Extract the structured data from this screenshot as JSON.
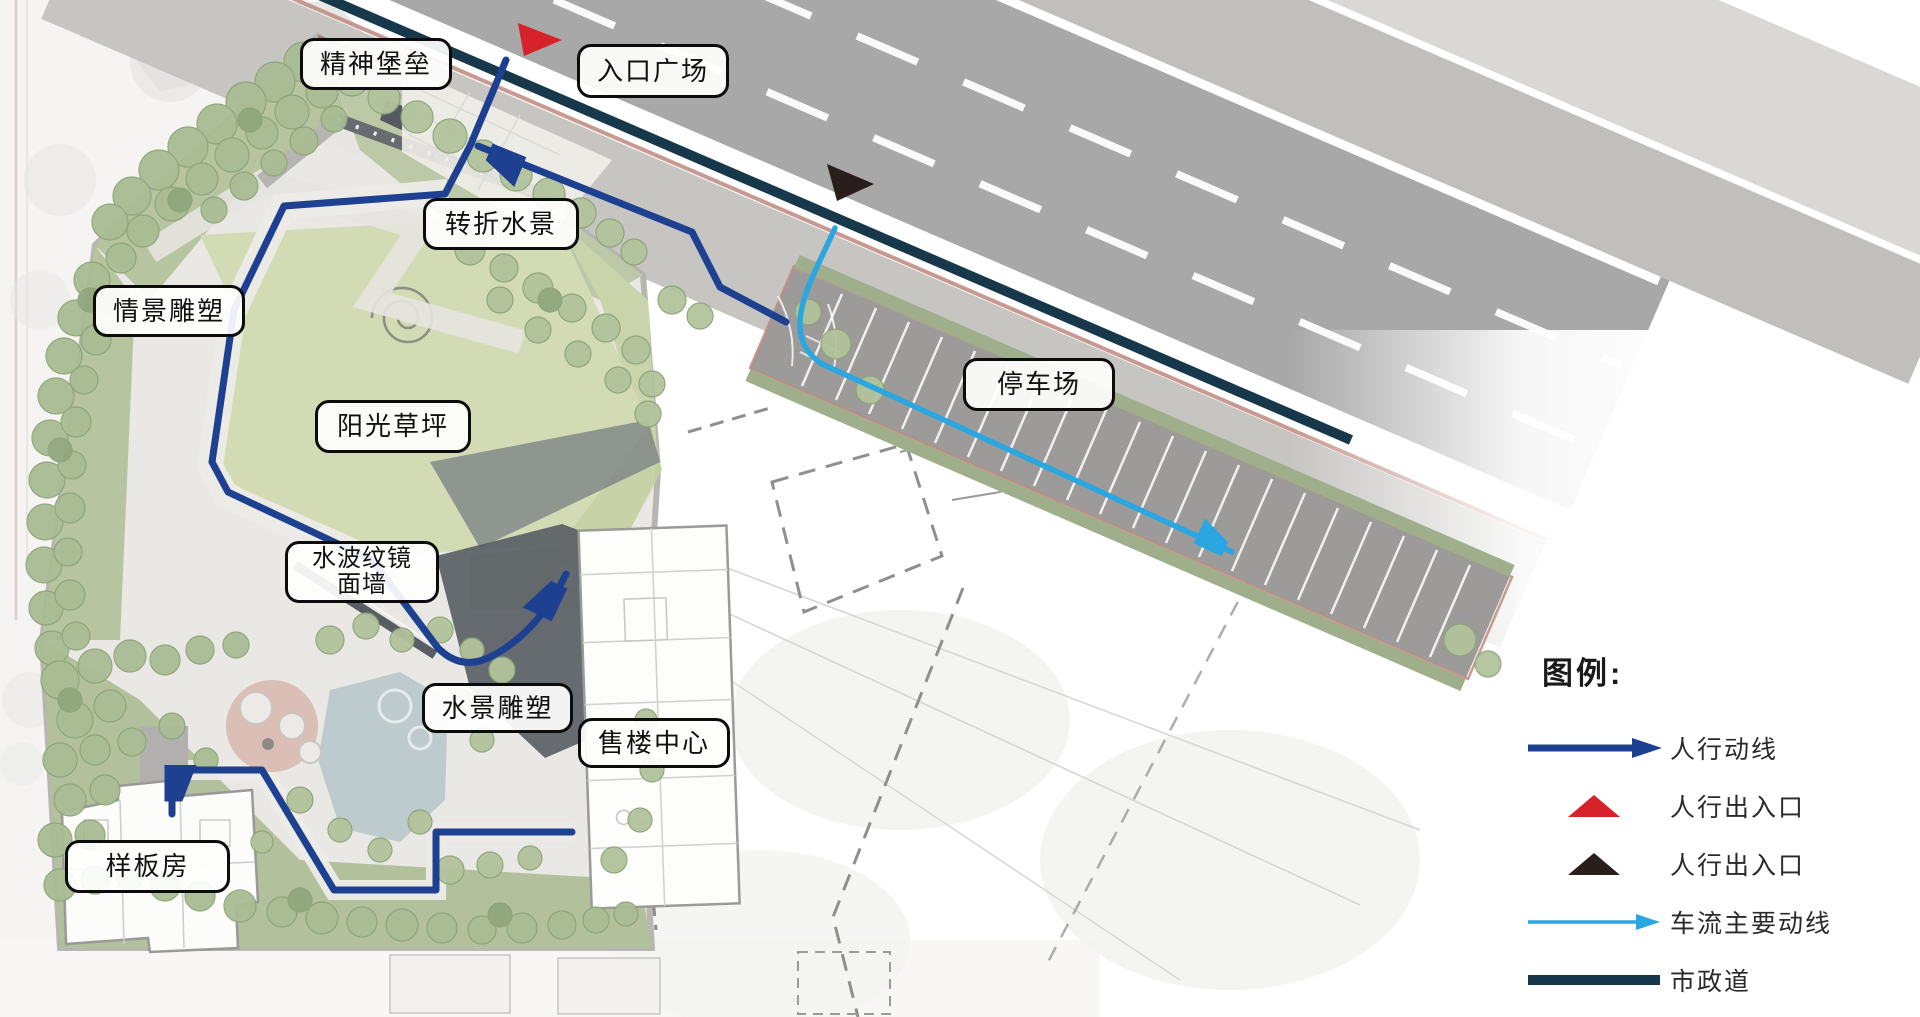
{
  "map_labels": [
    {
      "name": "spirit-fortress",
      "lines": [
        "精神堡垒"
      ]
    },
    {
      "name": "entrance-plaza",
      "lines": [
        "入口广场"
      ]
    },
    {
      "name": "turning-waterscape",
      "lines": [
        "转折水景"
      ]
    },
    {
      "name": "scene-sculpture",
      "lines": [
        "情景雕塑"
      ]
    },
    {
      "name": "sunshine-lawn",
      "lines": [
        "阳光草坪"
      ]
    },
    {
      "name": "parking-lot",
      "lines": [
        "停车场"
      ]
    },
    {
      "name": "water-ripple-mirror-wall",
      "lines": [
        "水波纹镜",
        "面墙"
      ]
    },
    {
      "name": "waterscape-sculpture",
      "lines": [
        "水景雕塑"
      ]
    },
    {
      "name": "sales-center",
      "lines": [
        "售楼中心"
      ]
    },
    {
      "name": "model-house",
      "lines": [
        "样板房"
      ]
    }
  ],
  "legend": {
    "title": "图例:",
    "items": [
      {
        "icon": "arrow-right-icon",
        "label": "人行动线",
        "color_ref": "pedestrian"
      },
      {
        "icon": "triangle-up-icon",
        "label": "人行出入口",
        "color_ref": "entrance_red"
      },
      {
        "icon": "triangle-up-icon",
        "label": "人行出入口",
        "color_ref": "entrance_black"
      },
      {
        "icon": "thin-arrow-right-icon",
        "label": "车流主要动线",
        "color_ref": "vehicle"
      },
      {
        "icon": "thick-line-icon",
        "label": "市政道",
        "color_ref": "municipal"
      }
    ]
  },
  "map_symbols": [
    {
      "icon": "red-triangle-icon",
      "meaning": "人行出入口"
    },
    {
      "icon": "black-triangle-icon",
      "meaning": "人行出入口"
    },
    {
      "icon": "dark-blue-arrow-line-icon",
      "meaning": "人行动线"
    },
    {
      "icon": "light-blue-arrow-line-icon",
      "meaning": "车流主要动线"
    },
    {
      "icon": "teal-line-icon",
      "meaning": "市政道"
    }
  ],
  "colors": {
    "pedestrian": "#1e4091",
    "vehicle": "#2aa7e0",
    "municipal": "#16384a",
    "entrance_red": "#d7222b",
    "entrance_black": "#2a1e1c"
  }
}
